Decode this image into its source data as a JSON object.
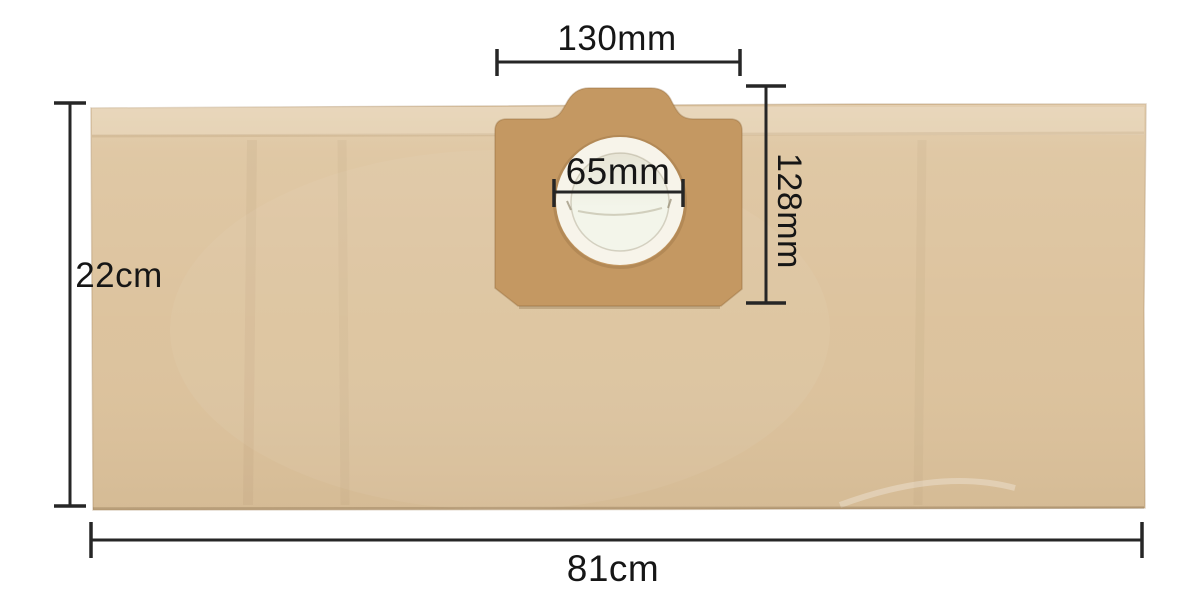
{
  "diagram": {
    "title": "vacuum-cleaner-dust-bag-dimension-diagram",
    "units": [
      "mm",
      "cm"
    ]
  },
  "dimensions": {
    "collar_width_label": "130mm",
    "hole_diameter_label": "65mm",
    "collar_height_label": "128mm",
    "bag_height_label": "22cm",
    "bag_width_label": "81cm"
  },
  "colors": {
    "background": "#ffffff",
    "bag": "#dcc29c",
    "collar": "#c49862",
    "ring": "#f7f4ea",
    "hole_top": "#e7e4d5",
    "hole_bottom": "#f3f5ea",
    "dimension_line": "#262626",
    "label_text": "#161616"
  }
}
